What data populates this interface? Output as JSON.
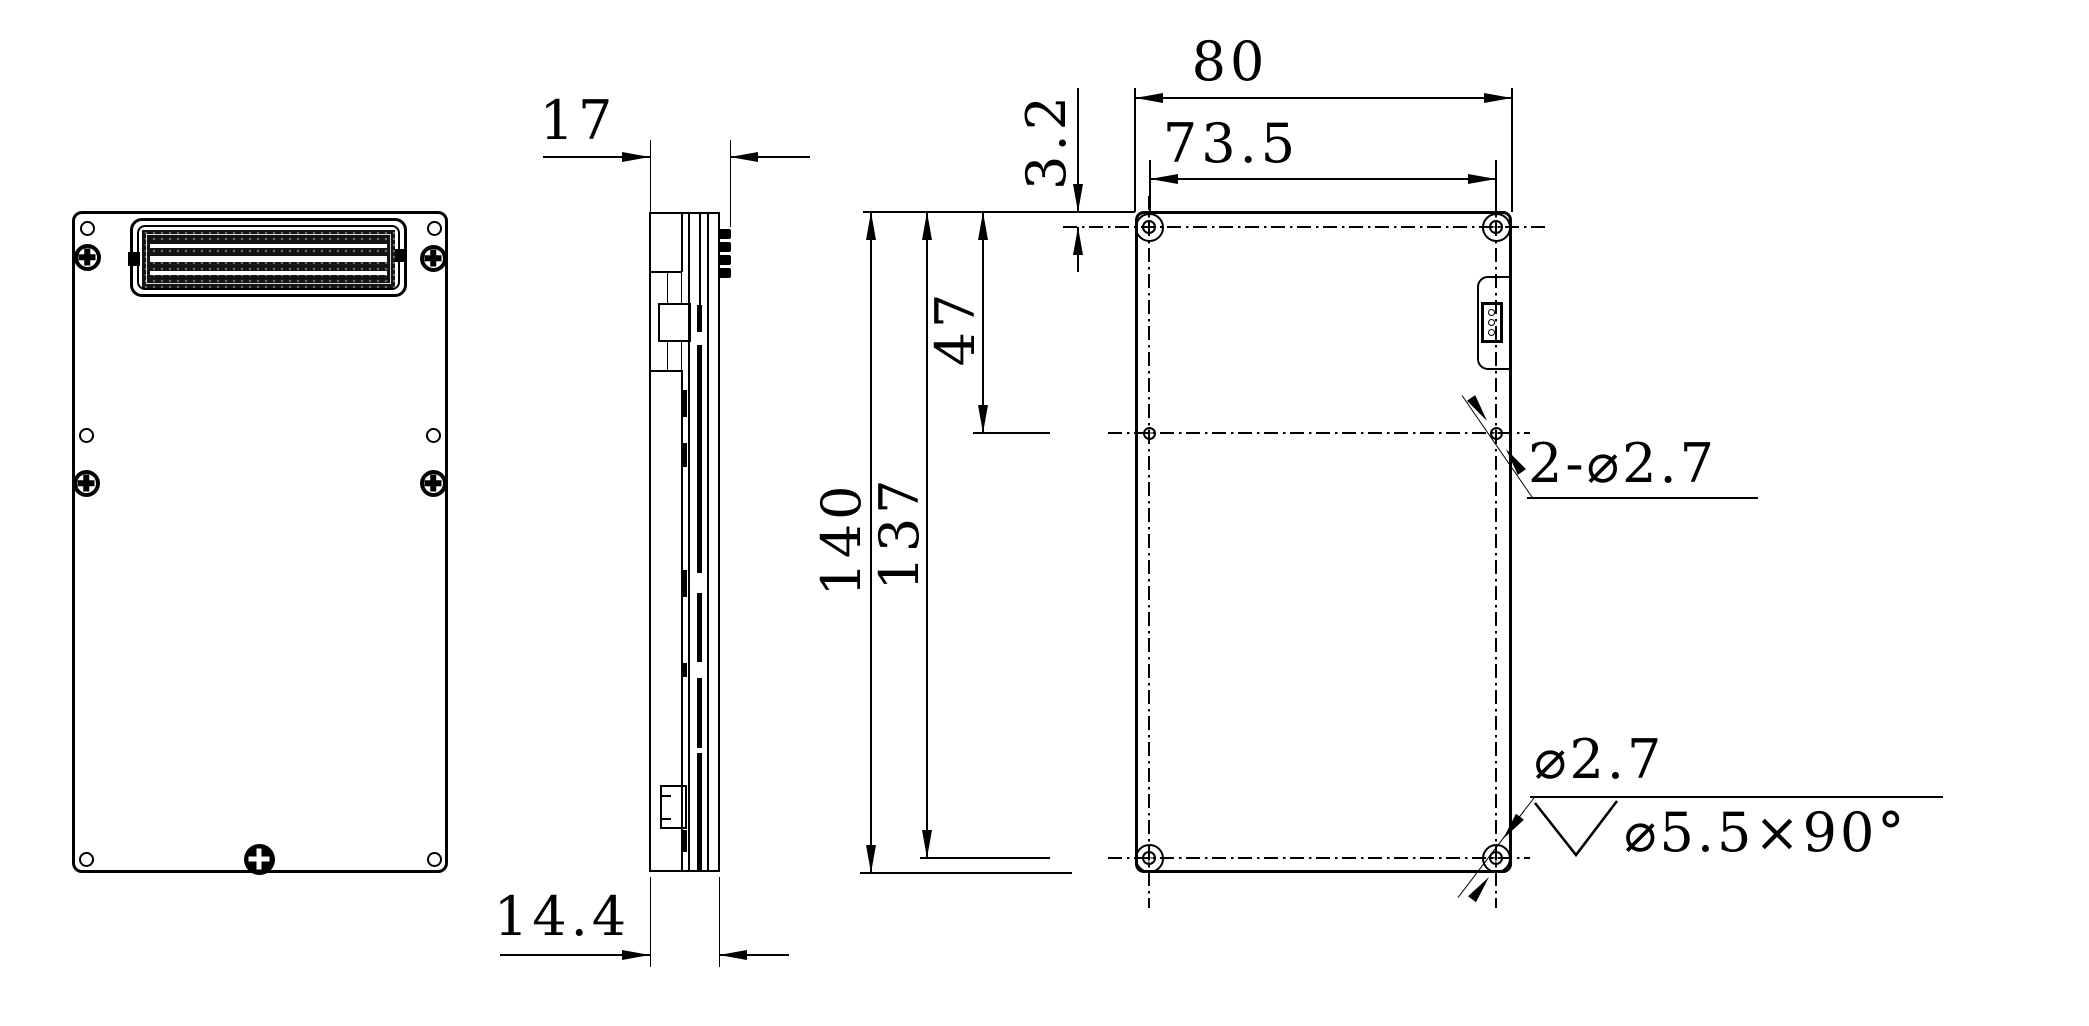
{
  "colors": {
    "background": "#ffffff",
    "line": "#000000"
  },
  "side_view": {
    "total_thickness": "17",
    "stack_thickness": "14.4"
  },
  "rear_view": {
    "overall_width": "80",
    "hole_span_width": "73.5",
    "top_hole_offset": "3.2",
    "mid_hole_offset": "47",
    "overall_height": "140",
    "hole_span_height": "137",
    "side_holes_callout": "2-⌀2.7",
    "corner_hole_diameter": "⌀2.7",
    "countersink_spec": "⌀5.5×90°"
  }
}
